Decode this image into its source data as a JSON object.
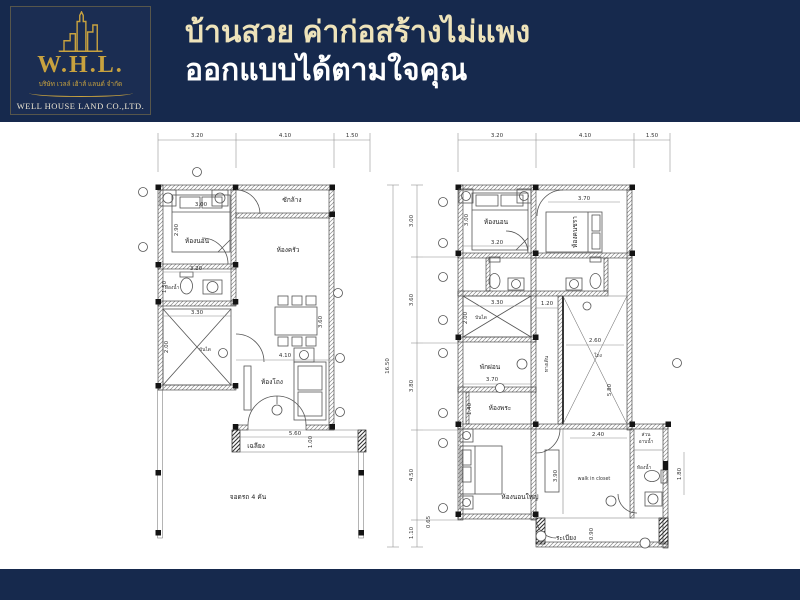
{
  "header": {
    "logo": {
      "abbr": "W.H.L.",
      "thai_company": "บริษัท เวลล์ เฮ้าส์ แลนด์ จำกัด",
      "company_en": "WELL HOUSE LAND CO.,LTD.",
      "icon": "building-skyline-icon"
    },
    "headline_line1": "บ้านสวย ค่าก่อสร้างไม่แพง",
    "headline_line2": "ออกแบบได้ตามใจคุณ"
  },
  "colors": {
    "navy": "#16294d",
    "gold": "#c8a23f",
    "cream": "#eee3ba",
    "white": "#ffffff"
  },
  "first_floor": {
    "top_dims": [
      "3.20",
      "4.10",
      "1.50"
    ],
    "labels": {
      "bedroom": "ห้องนอน",
      "laundry": "ซักล้าง",
      "kitchen": "ห้องครัว",
      "bath": "ห้องน้ำ",
      "stairs": "บันได",
      "hall": "ห้องโถง",
      "terrace": "เฉลียง",
      "carport": "จอดรถ 4 คัน"
    },
    "dims": {
      "bed_w": "3.00",
      "bedroom_h": "2.90",
      "bath_w": "3.20",
      "bath_h": "1.50",
      "stairs_w": "3.30",
      "stairs_h": "2.00",
      "dining_h": "3.60",
      "hall_w": "4.10",
      "terrace_w": "5.60",
      "terrace_h": "1.00"
    }
  },
  "second_floor": {
    "top_dims": [
      "3.20",
      "4.10",
      "1.50"
    ],
    "side_dims": [
      "3.00",
      "3.60",
      "3.80",
      "4.50",
      "1.10"
    ],
    "side_total": "16.50",
    "side_small": "0.65",
    "labels": {
      "bedroom": "ห้องนอน",
      "elder_bedroom": "ห้องคนชรา",
      "stairs": "บันได",
      "corridor": "ทางเดิน",
      "void": "โถง",
      "relax": "พักผ่อน",
      "prayer": "ห้องพระ",
      "master_bedroom": "ห้องนอนใหญ่",
      "walk_in_closet": "walk in closet",
      "bath": "ห้องน้ำ",
      "shower_1": "ส่วน",
      "shower_2": "อาบน้ำ",
      "balcony": "ระเบียง"
    },
    "dims": {
      "bed_w": "3.20",
      "bed_h": "3.00",
      "bed2_w": "3.70",
      "corridor_w": "1.20",
      "stairs_w": "3.30",
      "stairs_h": "2.00",
      "void_w": "2.60",
      "void_h": "5.80",
      "relax_w": "3.70",
      "prayer_h": "1.40",
      "closet_w": "2.40",
      "master_h": "3.90",
      "bath_side": "1.80",
      "balcony_h": "0.90"
    }
  }
}
